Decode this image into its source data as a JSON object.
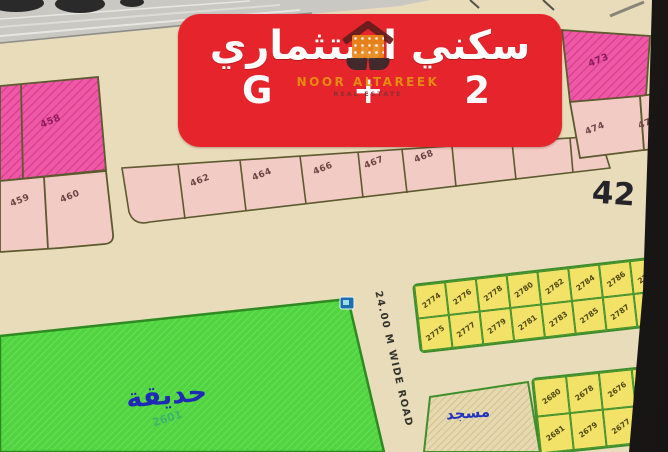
{
  "banner": {
    "title_ar": "سكني استثماري",
    "floors_left": "G",
    "floors_plus": "+",
    "floors_right": "2",
    "bg_color": "#e5242b"
  },
  "watermark": {
    "brand": "NOOR ALTAREEK",
    "tagline": "REAL ESTATE",
    "logo": "house-and-book-logo",
    "brand_color": "#e8930f"
  },
  "map": {
    "district_number": "42",
    "road_label": "24.00 M WIDE ROAD",
    "park": {
      "label_ar": "حديقة",
      "plot_number": "2601",
      "color": "#52d342"
    },
    "mosque": {
      "label_ar": "مسجد"
    },
    "pink_left": {
      "hatched_plot": "458",
      "plain_plots": [
        "459",
        "460"
      ]
    },
    "pink_strip_plots": [
      "462",
      "464",
      "466",
      "467",
      "468"
    ],
    "pink_right": {
      "hatched_plot": "473",
      "plain_plots": [
        "474",
        "475"
      ]
    },
    "yellow_upper": {
      "top_row": [
        "2774",
        "2776",
        "2778",
        "2780",
        "2782",
        "2784",
        "2786",
        "2788"
      ],
      "bottom_row": [
        "2775",
        "2777",
        "2779",
        "2781",
        "2783",
        "2785",
        "2787",
        "2789"
      ]
    },
    "yellow_lower": {
      "top_row": [
        "2680",
        "2678",
        "2676",
        "2674"
      ],
      "bottom_row": [
        "2681",
        "2679",
        "2677",
        "2675"
      ]
    },
    "colors": {
      "background": "#e9dcba",
      "plot_pink": "#f2cbc5",
      "plot_pink_hatched": "#ee58a5",
      "plot_yellow": "#f2e268",
      "park_green": "#52d342",
      "marker_blue": "#1b6fae"
    }
  }
}
